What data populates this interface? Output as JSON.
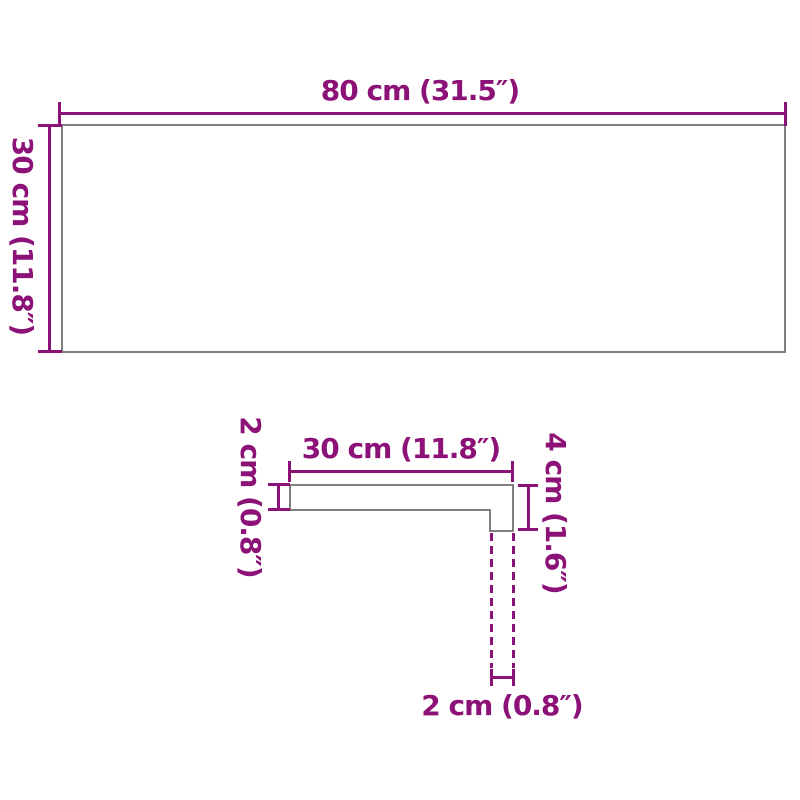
{
  "colors": {
    "dimension": "#8C1277",
    "outline": "#7F7F7F",
    "background": "#FFFFFF"
  },
  "top_figure": {
    "width_label": "80 cm (31.5″)",
    "height_label": "30 cm (11.8″)"
  },
  "profile_figure": {
    "width_label": "30 cm (11.8″)",
    "thickness_label": "2 cm (0.8″)",
    "height_label": "4 cm (1.6″)",
    "nose_depth_label": "2 cm (0.8″)"
  }
}
